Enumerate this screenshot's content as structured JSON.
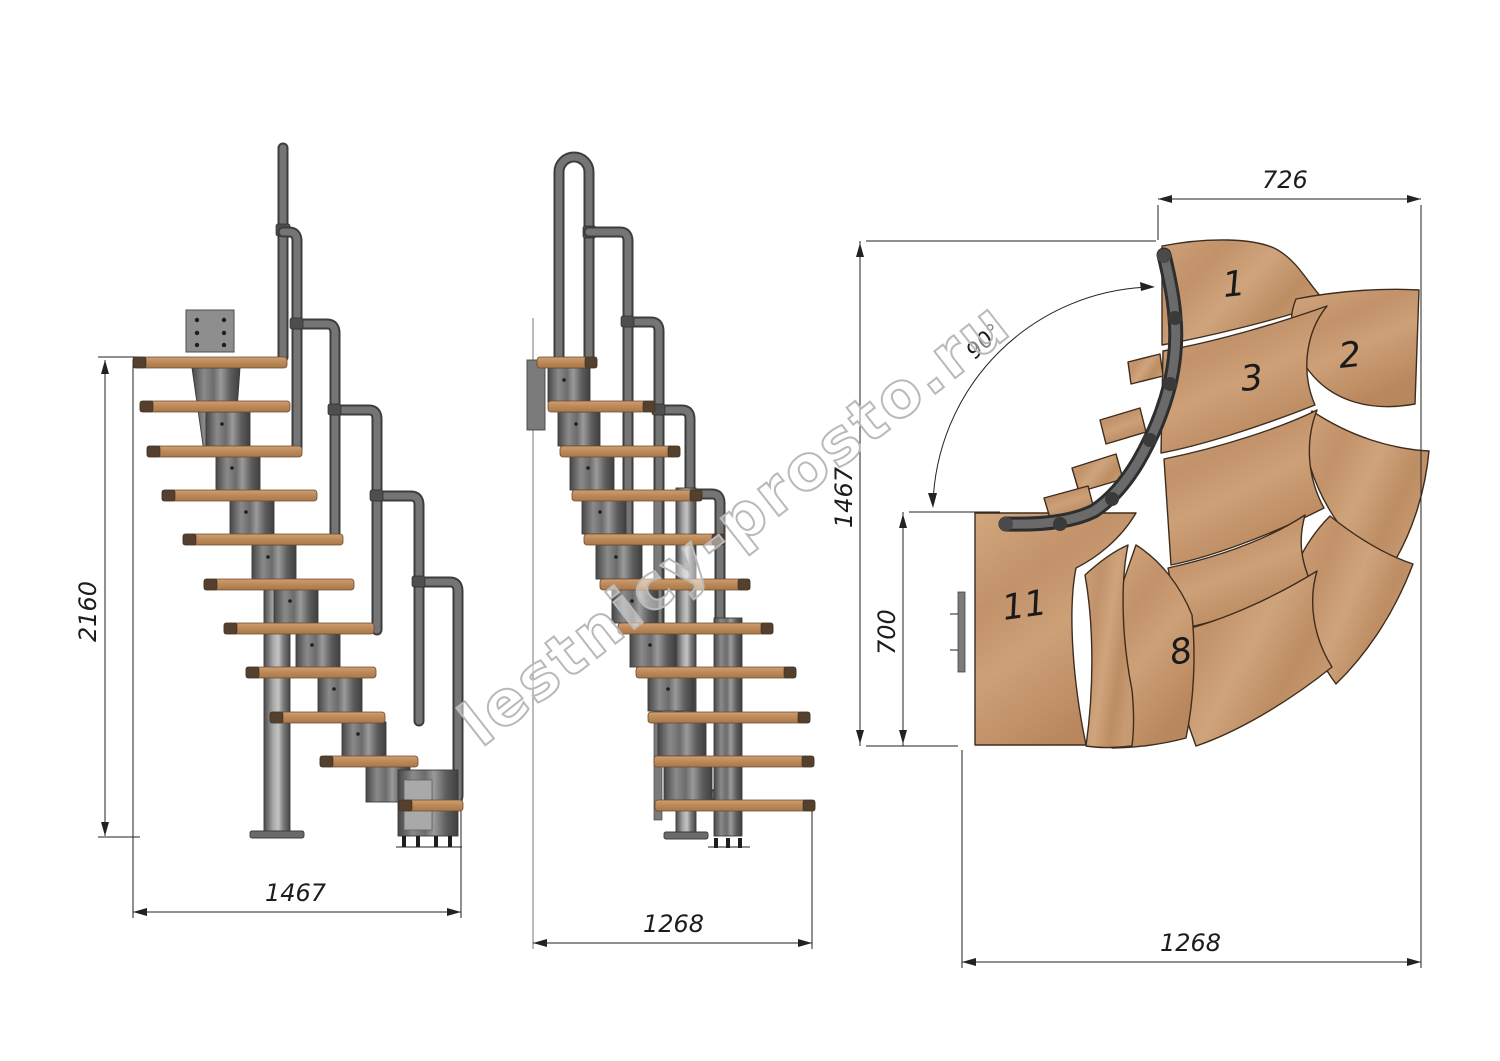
{
  "watermark": {
    "text": "lestnicy-prosto.ru"
  },
  "views": {
    "side_a": {
      "label": "side elevation (front)",
      "dim_height": "2160",
      "dim_width": "1467"
    },
    "side_b": {
      "label": "side elevation (profile)",
      "dim_width": "1268"
    },
    "plan": {
      "label": "plan view, 90 degree turn",
      "dim_top": "726",
      "dim_left_outer": "1467",
      "dim_left_inner": "700",
      "dim_bottom": "1268",
      "angle_label": "90°",
      "step_labels": [
        "1",
        "2",
        "3",
        "8",
        "11"
      ]
    }
  },
  "colors": {
    "wood": "#c69c74",
    "wood_dark": "#ad7c50",
    "metal": "#6f6f6f",
    "drawing_line": "#222222",
    "watermark_gray": "#b9b9b9"
  }
}
